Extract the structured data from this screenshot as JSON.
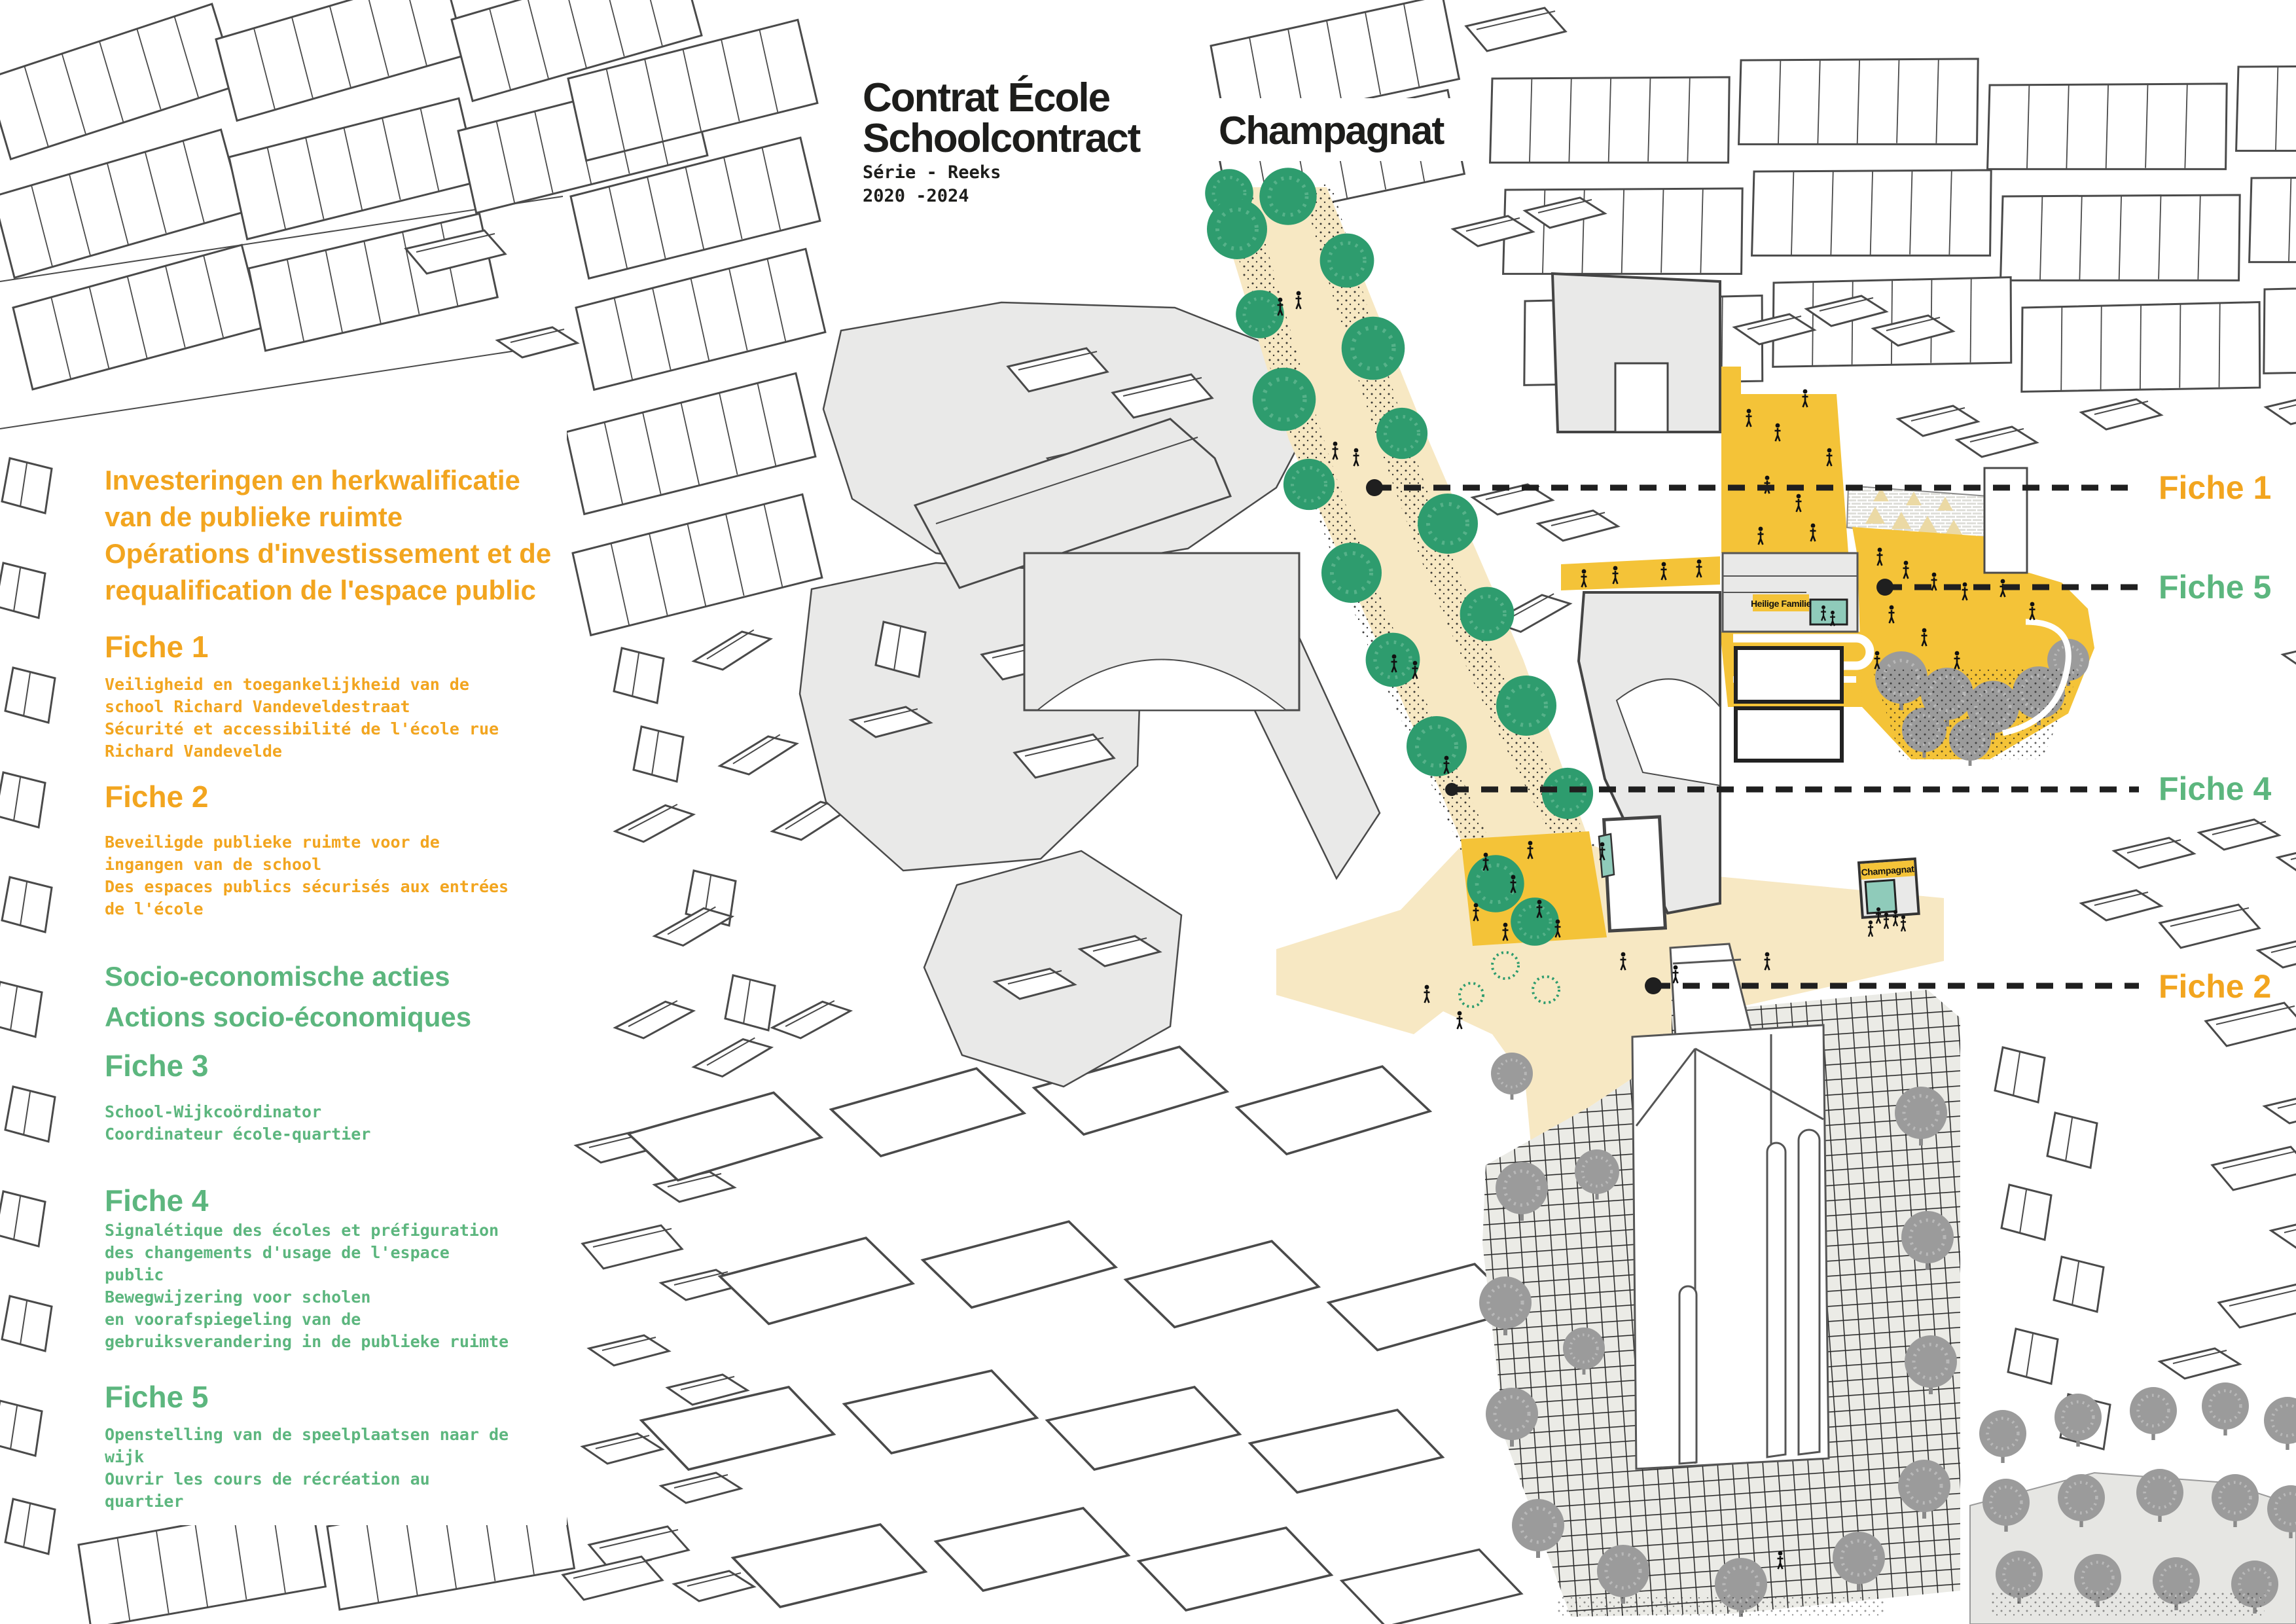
{
  "title": {
    "line1": "Contrat École",
    "line2": "Schoolcontract",
    "series_line1": "Série - Reeks",
    "series_line2": "2020 -2024",
    "project": "Champagnat"
  },
  "colors": {
    "orange": "#F2A51F",
    "green": "#5CB67E",
    "map_yellow": "#F4C338",
    "street_tan": "#F7E8C3",
    "courtyard_teal": "#8FCBBA",
    "tree_green": "#2E9C6E"
  },
  "legend": {
    "public_space": {
      "header_lines": [
        "Investeringen en herkwalificatie",
        "van de publieke ruimte",
        "Opérations d'investissement et de",
        "requalification de l'espace public"
      ],
      "fiches": [
        {
          "title": "Fiche 1",
          "lines": [
            "Veiligheid en toegankelijkheid van de",
            "school Richard Vandeveldestraat",
            "Sécurité et accessibilité de l'école rue",
            "Richard Vandevelde"
          ]
        },
        {
          "title": "Fiche 2",
          "lines": [
            "Beveiligde publieke ruimte voor de",
            "ingangen van de school",
            "Des espaces publics sécurisés aux entrées",
            "de l'école"
          ]
        }
      ]
    },
    "socio": {
      "header_lines": [
        "Socio-economische acties",
        "Actions socio-économiques"
      ],
      "fiches": [
        {
          "title": "Fiche 3",
          "lines": [
            "School-Wijkcoördinator",
            "Coordinateur école-quartier"
          ]
        },
        {
          "title": "Fiche 4",
          "lines": [
            "Signalétique des écoles et préfiguration",
            "des changements d'usage de l'espace",
            "public",
            "Bewegwijzering voor scholen",
            "en voorafspiegeling van de",
            "gebruiksverandering in de publieke ruimte"
          ]
        },
        {
          "title": "Fiche 5",
          "lines": [
            "Openstelling van de speelplaatsen naar de",
            "wijk",
            "Ouvrir les cours de récréation au",
            "quartier"
          ]
        }
      ]
    }
  },
  "map_labels": {
    "fiche1": "Fiche 1",
    "fiche5": "Fiche 5",
    "fiche4": "Fiche 4",
    "fiche2": "Fiche 2",
    "school_heilige_familie": "Heilige Familie",
    "school_champagnat": "Champagnat"
  }
}
